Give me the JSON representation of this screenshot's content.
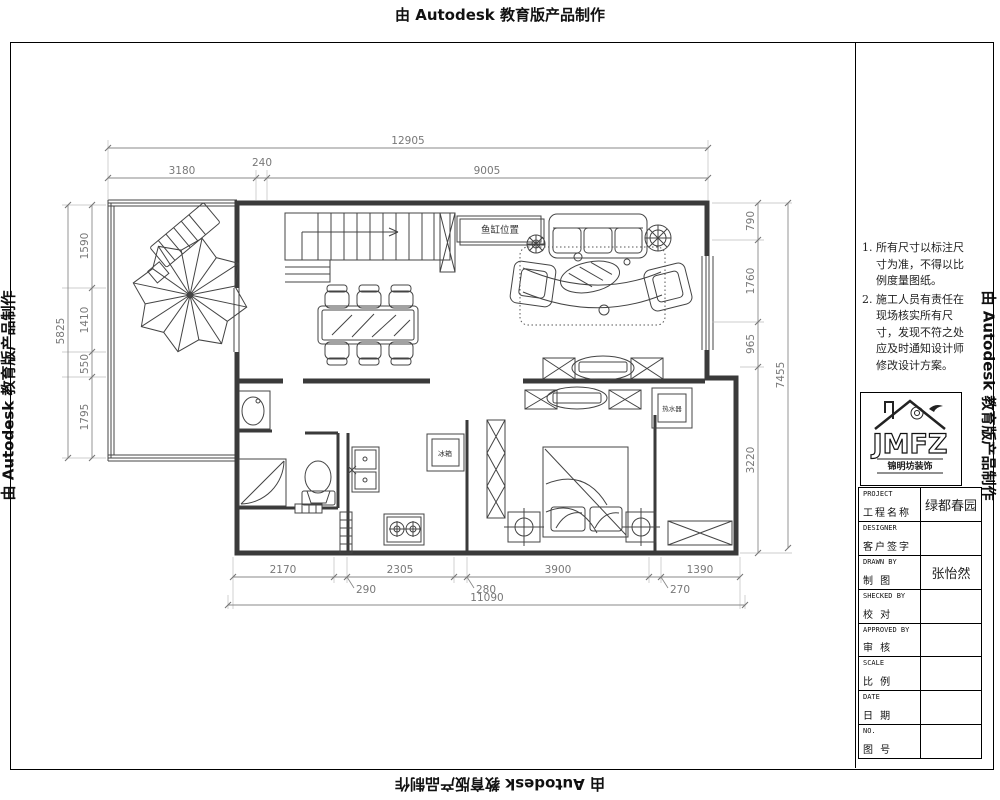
{
  "stamp": {
    "text": "由 Autodesk 教育版产品制作"
  },
  "notes": {
    "n1": "1.",
    "t1": "所有尺寸以标注尺寸为准，不得以比例度量图纸。",
    "n2": "2.",
    "t2": "施工人员有责任在现场核实所有尺寸，发现不符之处应及时通知设计师修改设计方案。"
  },
  "logo": {
    "name": "JMFZ",
    "sub": "锦明坊装饰"
  },
  "titleblock": {
    "rows": [
      {
        "en": "PROJECT",
        "zh": "工程名称",
        "value": "绿都春园"
      },
      {
        "en": "DESIGNER",
        "zh": "客户签字",
        "value": ""
      },
      {
        "en": "DRAWN BY",
        "zh": "制 图",
        "value": "张怡然"
      },
      {
        "en": "SHECKED BY",
        "zh": "校 对",
        "value": ""
      },
      {
        "en": "APPROVED BY",
        "zh": "审 核",
        "value": ""
      },
      {
        "en": "SCALE",
        "zh": "比 例",
        "value": ""
      },
      {
        "en": "DATE",
        "zh": "日 期",
        "value": ""
      },
      {
        "en": "NO.",
        "zh": "图 号",
        "value": ""
      }
    ]
  },
  "plan_labels": {
    "fish_tank": "鱼缸位置",
    "fridge": "冰箱",
    "water_heater": "热水器"
  },
  "dimensions": {
    "top": {
      "overall": "12905",
      "segs": [
        "3180",
        "240",
        "9005"
      ]
    },
    "left": {
      "overall": "5825",
      "segs": [
        "1590",
        "1410",
        "550",
        "1795"
      ]
    },
    "right": {
      "overall": "7455",
      "segs": [
        "790",
        "1760",
        "965",
        "3220"
      ]
    },
    "bottom": {
      "overall": "11090",
      "segs": [
        "2170",
        "290",
        "2305",
        "280",
        "3900",
        "270",
        "1390"
      ]
    }
  }
}
